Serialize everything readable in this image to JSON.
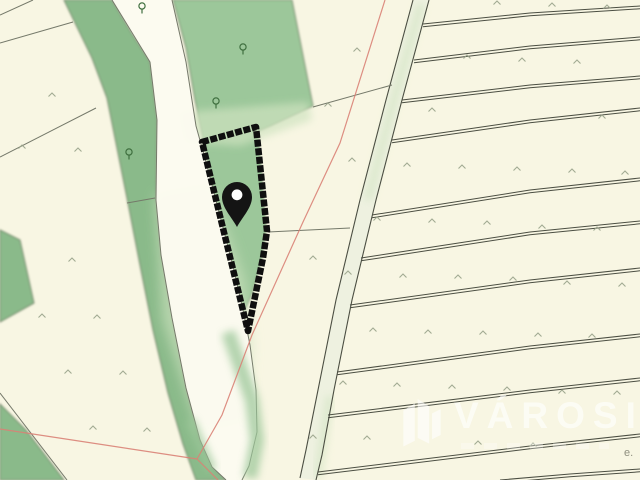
{
  "map": {
    "type": "cadastral-parcel-map",
    "watermark": {
      "text": "VÁROSI",
      "logo_icon": "varosi-logo-icon"
    },
    "labels": {
      "edge_label": "e."
    },
    "marker": {
      "icon": "location-pin-icon"
    }
  },
  "colors": {
    "bg": "#f8f6e3",
    "greenDark": "#8aba8a",
    "greenMid": "#9cc79a",
    "greenLight": "#cfe3c0",
    "roadFill": "#fcfbf0",
    "roadFill2": "#eef1e0",
    "boundary": "#75796a",
    "stripLine": "#4b4e42",
    "red": "#d98276",
    "highlight": "#0f0f0f",
    "caret": "#98a28a",
    "tree": "#3f6f3f",
    "watermark": "rgba(255,255,255,0.62)",
    "labelGray": "#8f8f7f"
  },
  "features": {
    "boundary_lines": [
      [
        [
          0,
          15
        ],
        [
          33,
          0
        ]
      ],
      [
        [
          0,
          43
        ],
        [
          73,
          22
        ]
      ],
      [
        [
          0,
          157
        ],
        [
          96,
          108
        ]
      ],
      [
        [
          127,
          203
        ],
        [
          155,
          198
        ]
      ],
      [
        [
          313,
          107
        ],
        [
          392,
          85
        ]
      ],
      [
        [
          268,
          232
        ],
        [
          350,
          228
        ]
      ],
      [
        [
          0,
          393
        ],
        [
          67,
          480
        ]
      ]
    ],
    "strip_lines": [
      [
        [
          423,
          24
        ],
        [
          530,
          13
        ],
        [
          640,
          6
        ]
      ],
      [
        [
          414,
          60
        ],
        [
          530,
          46
        ],
        [
          640,
          37
        ]
      ],
      [
        [
          402,
          100
        ],
        [
          530,
          85
        ],
        [
          640,
          76
        ]
      ],
      [
        [
          392,
          140
        ],
        [
          530,
          120
        ],
        [
          640,
          108
        ]
      ],
      [
        [
          372,
          215
        ],
        [
          530,
          190
        ],
        [
          640,
          178
        ]
      ],
      [
        [
          361,
          258
        ],
        [
          530,
          232
        ],
        [
          640,
          221
        ]
      ],
      [
        [
          350,
          305
        ],
        [
          530,
          280
        ],
        [
          640,
          268
        ]
      ],
      [
        [
          337,
          372
        ],
        [
          530,
          346
        ],
        [
          640,
          334
        ]
      ],
      [
        [
          328,
          415
        ],
        [
          530,
          390
        ],
        [
          640,
          378
        ]
      ],
      [
        [
          318,
          472
        ],
        [
          530,
          446
        ],
        [
          640,
          434
        ]
      ],
      [
        [
          500,
          480
        ],
        [
          570,
          474
        ],
        [
          640,
          469
        ]
      ]
    ],
    "red_lines": [
      [
        [
          385,
          0
        ],
        [
          340,
          143
        ],
        [
          303,
          222
        ],
        [
          252,
          335
        ],
        [
          222,
          415
        ],
        [
          197,
          459
        ]
      ],
      [
        [
          0,
          429
        ],
        [
          197,
          459
        ]
      ],
      [
        [
          197,
          459
        ],
        [
          218,
          480
        ]
      ]
    ],
    "grass_marks": [
      [
        52,
        95
      ],
      [
        22,
        147
      ],
      [
        78,
        150
      ],
      [
        72,
        260
      ],
      [
        42,
        316
      ],
      [
        97,
        317
      ],
      [
        68,
        372
      ],
      [
        123,
        373
      ],
      [
        93,
        428
      ],
      [
        147,
        430
      ],
      [
        357,
        50
      ],
      [
        328,
        105
      ],
      [
        352,
        160
      ],
      [
        313,
        258
      ],
      [
        348,
        273
      ],
      [
        497,
        3
      ],
      [
        552,
        5
      ],
      [
        607,
        7
      ],
      [
        467,
        57
      ],
      [
        522,
        60
      ],
      [
        577,
        62
      ],
      [
        432,
        110
      ],
      [
        602,
        117
      ],
      [
        407,
        165
      ],
      [
        462,
        167
      ],
      [
        517,
        169
      ],
      [
        572,
        171
      ],
      [
        625,
        173
      ],
      [
        377,
        219
      ],
      [
        432,
        221
      ],
      [
        487,
        223
      ],
      [
        542,
        227
      ],
      [
        597,
        229
      ],
      [
        403,
        276
      ],
      [
        458,
        277
      ],
      [
        513,
        279
      ],
      [
        567,
        283
      ],
      [
        622,
        285
      ],
      [
        373,
        330
      ],
      [
        428,
        332
      ],
      [
        483,
        333
      ],
      [
        538,
        335
      ],
      [
        592,
        336
      ],
      [
        343,
        383
      ],
      [
        397,
        385
      ],
      [
        452,
        387
      ],
      [
        507,
        389
      ],
      [
        562,
        392
      ],
      [
        617,
        393
      ],
      [
        313,
        437
      ],
      [
        367,
        438
      ],
      [
        478,
        443
      ],
      [
        533,
        445
      ]
    ],
    "trees": [
      [
        243,
        47
      ],
      [
        216,
        101
      ],
      [
        129,
        152
      ],
      [
        142,
        6
      ]
    ]
  }
}
